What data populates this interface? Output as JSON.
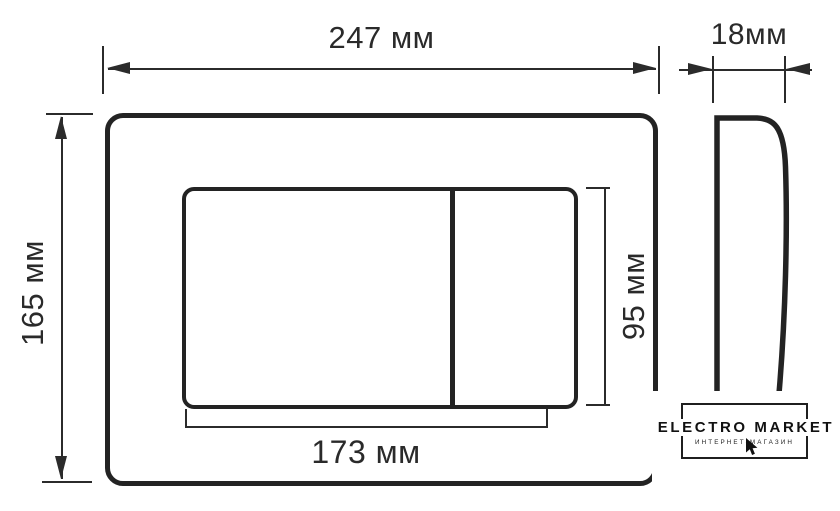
{
  "front_view": {
    "overall_width": "247 мм",
    "overall_height": "165 мм",
    "panel_width": "173 мм",
    "panel_height": "95 мм"
  },
  "side_view": {
    "depth": "18мм"
  },
  "watermark": {
    "brand": "ELECTRO MARKET",
    "tagline": "ИНТЕРНЕТ-МАГАЗИН"
  },
  "colors": {
    "line": "#2b2b2b",
    "background": "#ffffff"
  }
}
